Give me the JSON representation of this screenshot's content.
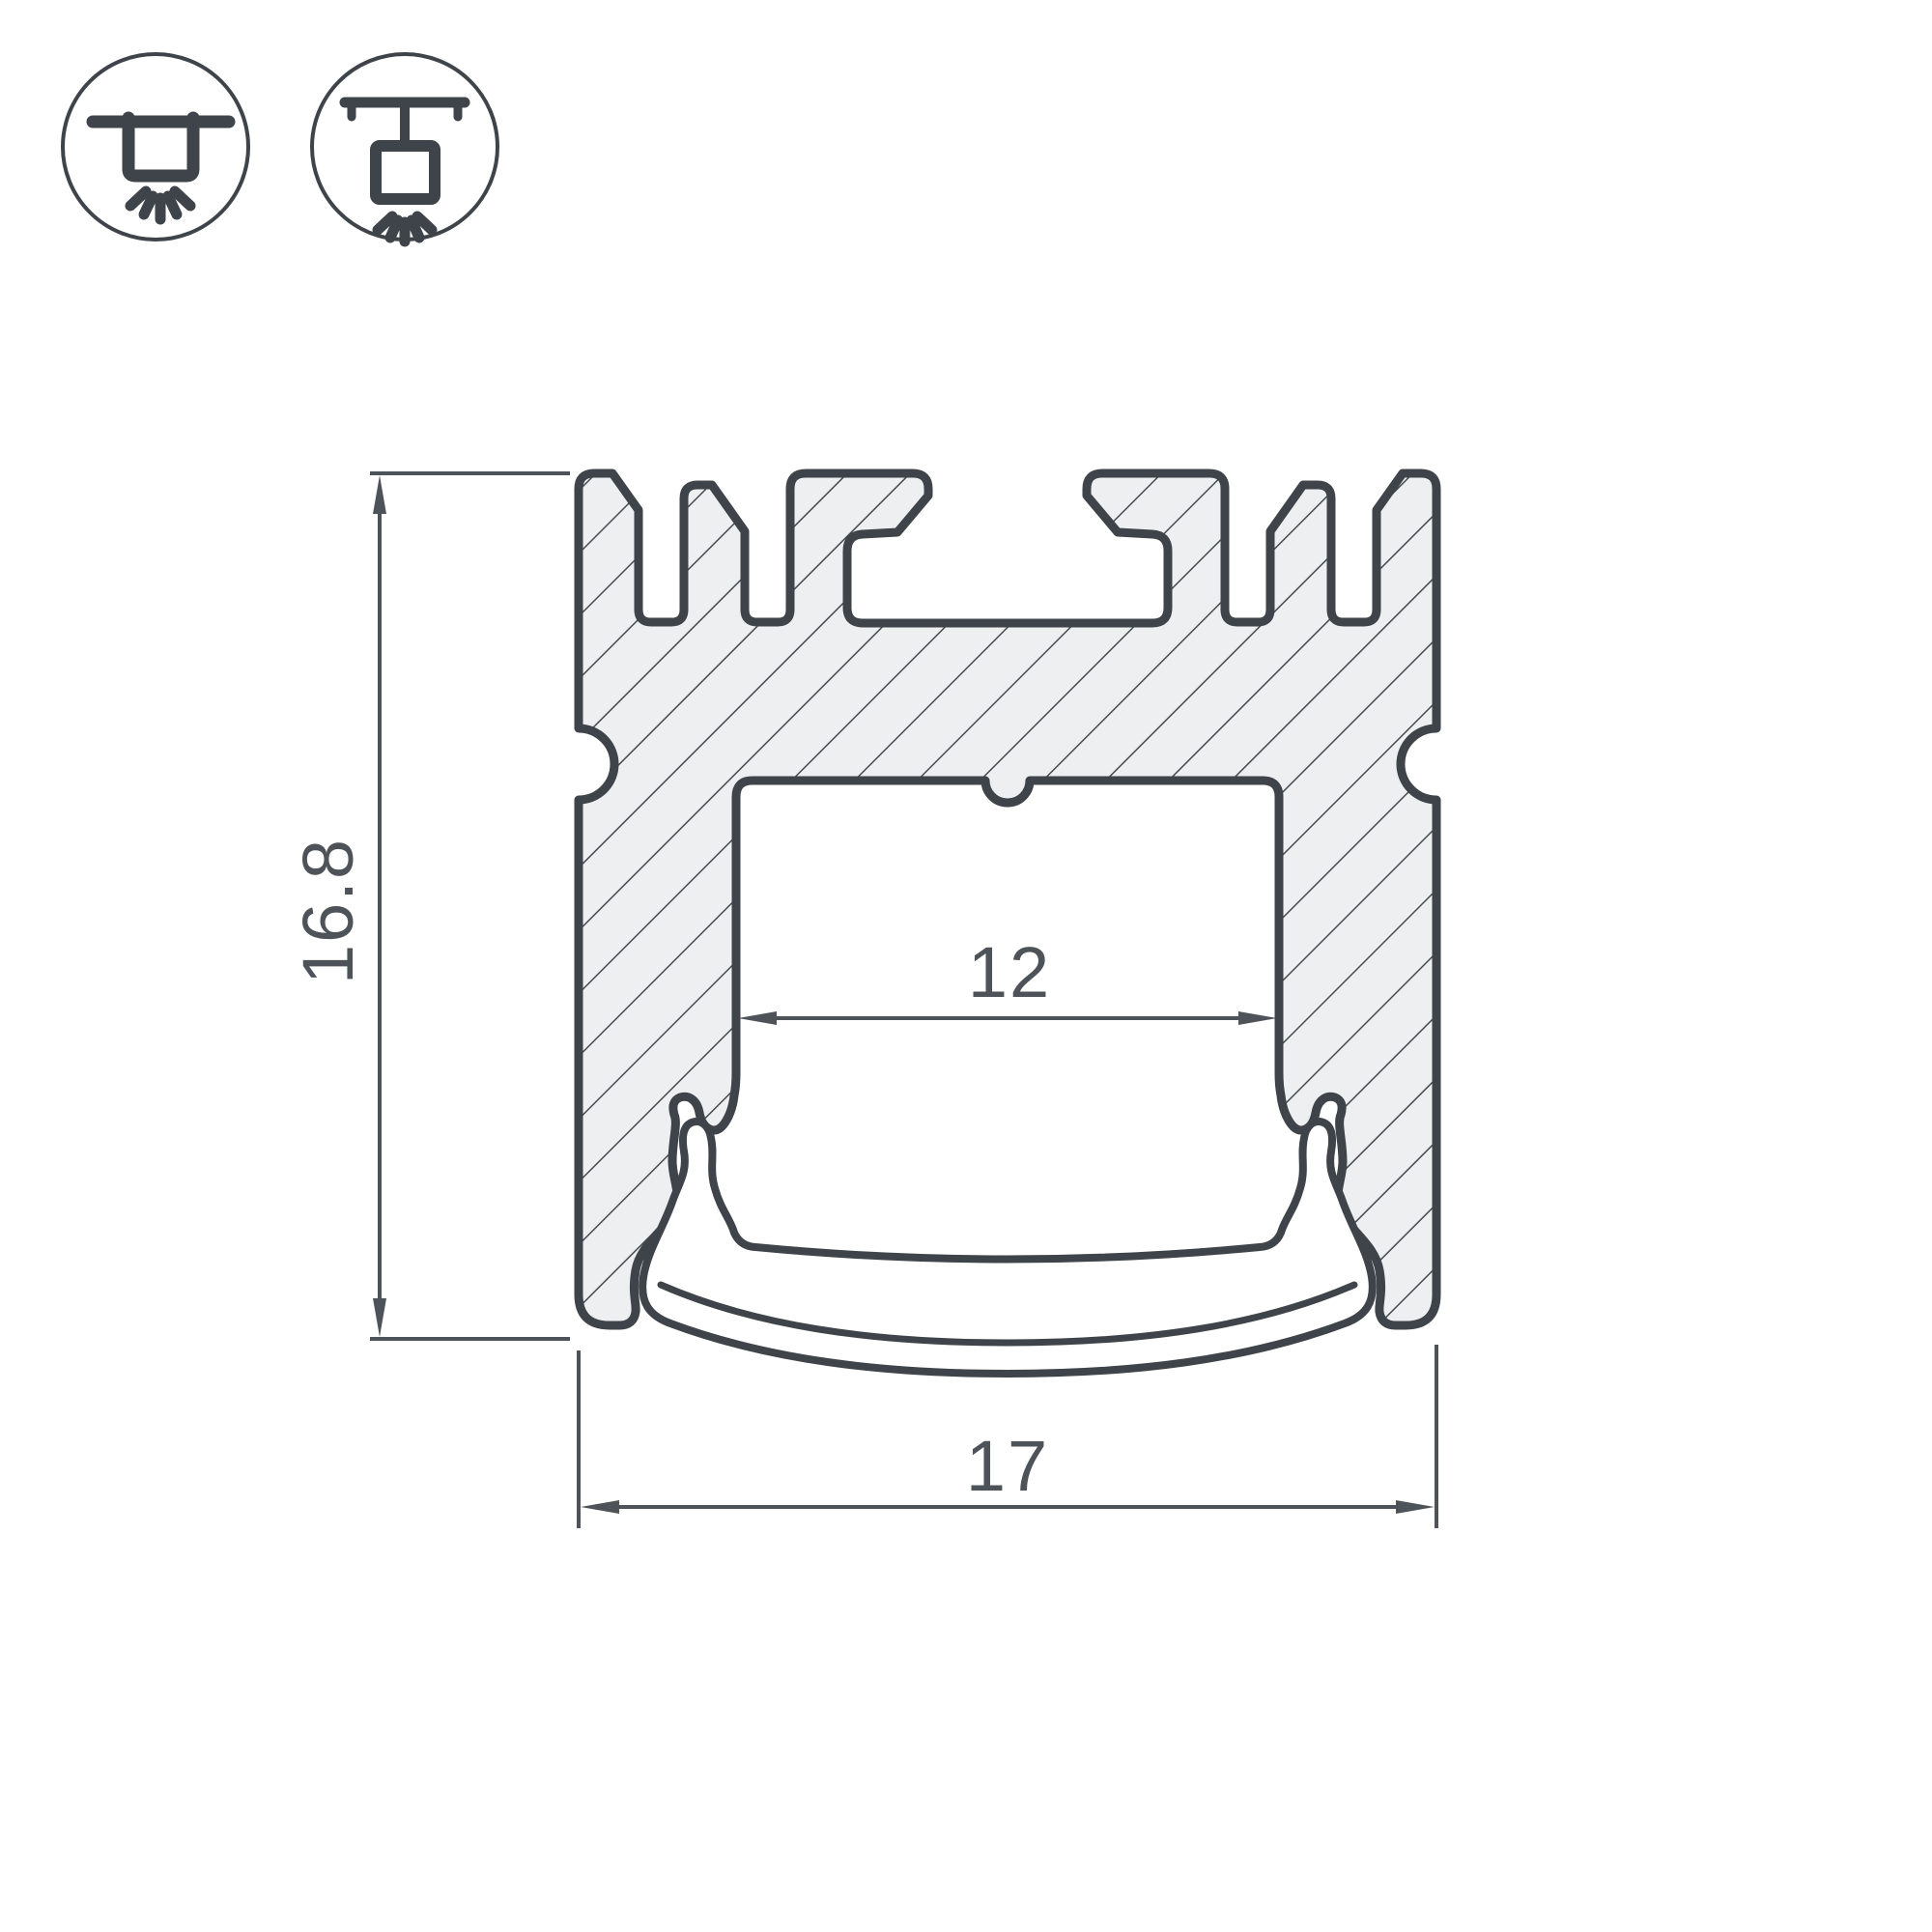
{
  "drawing": {
    "title": "led-profile-cross-section",
    "dimensions": {
      "height_label": "16.8",
      "outer_width_label": "17",
      "inner_width_label": "12"
    }
  },
  "icons": [
    {
      "name": "surface-mount-light-icon"
    },
    {
      "name": "pendant-mount-light-icon"
    }
  ],
  "colors": {
    "outline": "#3e4449",
    "hatch": "#454c51",
    "aluminum_fill": "#edeff0",
    "diffuser_fill": "#ffffff",
    "dimension": "#4d5358",
    "background": "#ffffff"
  }
}
